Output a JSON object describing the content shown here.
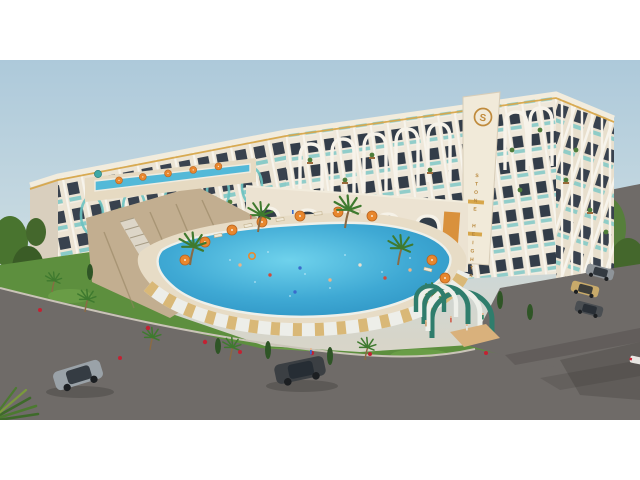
{
  "branding": {
    "logo_letter": "S",
    "building_name_vertical": "STONE HEIGHTS"
  },
  "scene": {
    "type": "3d-architectural-render",
    "subject": "aerial view of Stone Heights resort residence with courtyard pool",
    "elements": [
      "curved-apartment-building",
      "logo-tower",
      "main-swimming-pool",
      "upper-terrace-pool",
      "pool-deck-with-umbrellas",
      "decorative-curved-wall",
      "stone-retaining-wall",
      "grand-staircase",
      "arched-entrance-tunnel",
      "landscaped-grass-with-palms",
      "parking-area",
      "access-roads"
    ]
  },
  "palette": {
    "letterbox_white": "#ffffff",
    "sky_top": "#adc9da",
    "sky_horizon": "#ded8cb",
    "facade_cream": "#ece4d4",
    "facade_white": "#f7f4ec",
    "window_dark": "#39424e",
    "glass_teal": "#79c7c6",
    "trim_gold": "#d7a64a",
    "logo_gold": "#c08b3c",
    "pool_water": "#2a8fc0",
    "pool_light": "#6fd2ec",
    "deck_sand": "#e7dcc6",
    "wall_slat_wood": "#d9b877",
    "grass_green": "#5d8f3e",
    "tree_green": "#49742f",
    "road_asphalt": "#6f6b68",
    "stone_wall_tan": "#c2ae90",
    "umbrella_orange": "#e8872e",
    "flower_red": "#c22233",
    "tunnel_green": "#2f7d6c"
  },
  "vehicles": [
    {
      "name": "silver-sedan",
      "color": "#9aa2a8",
      "location": "road-lower-left"
    },
    {
      "name": "dark-suv",
      "color": "#3b3f43",
      "location": "road-bottom-center"
    },
    {
      "name": "parked-car-silver",
      "color": "#8e9499",
      "location": "parking-right"
    },
    {
      "name": "parked-car-tan",
      "color": "#c8aa6a",
      "location": "parking-right"
    },
    {
      "name": "parked-sedan-dark",
      "color": "#4a4e52",
      "location": "parking-right"
    },
    {
      "name": "small-car-partial",
      "color": "#e8e6e2",
      "location": "right-edge"
    }
  ]
}
